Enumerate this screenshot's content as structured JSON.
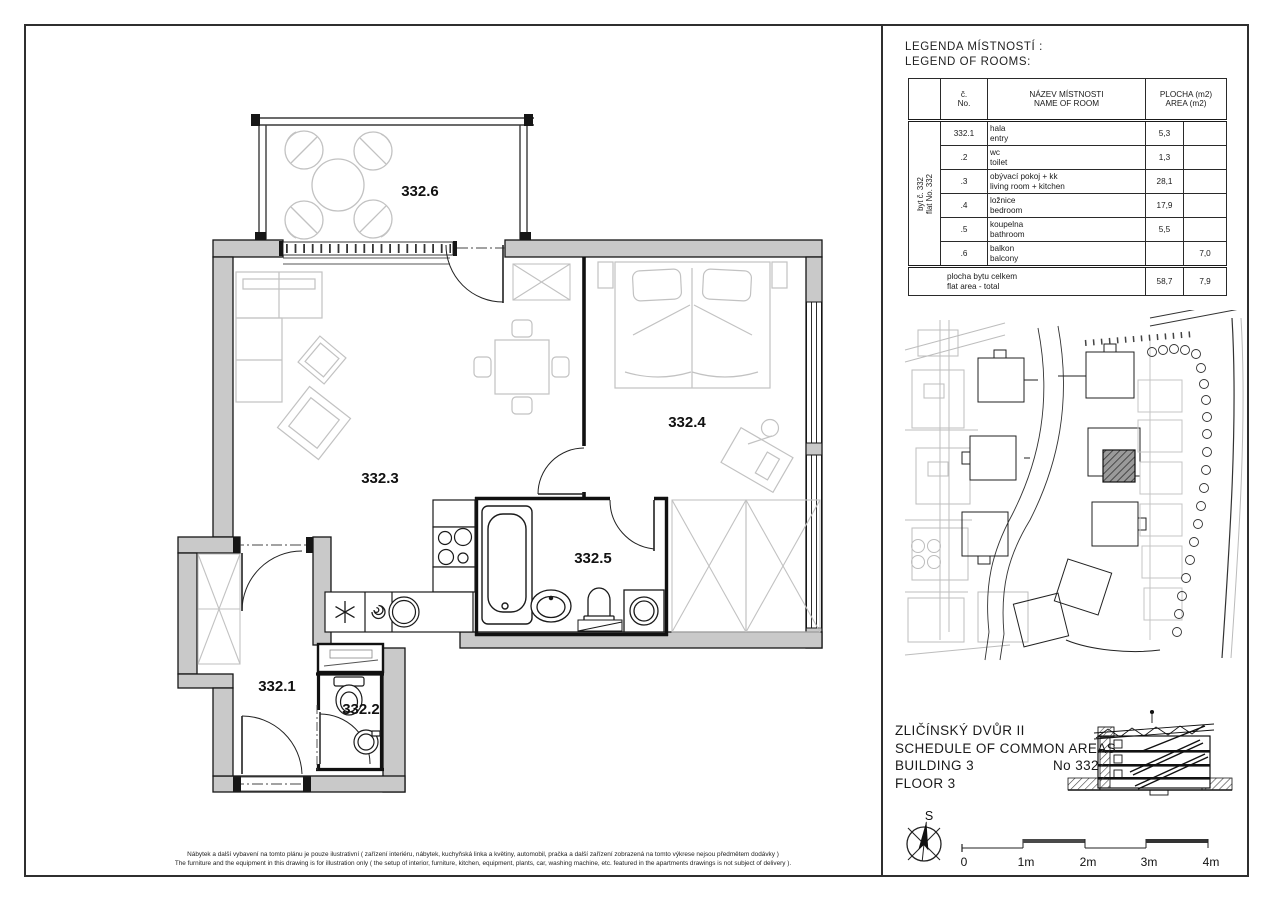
{
  "legend": {
    "title_cs": "LEGENDA MÍSTNOSTÍ :",
    "title_en": "LEGEND OF ROOMS:",
    "table": {
      "flat_cs": "byt č. 332",
      "flat_en": "flat No. 332",
      "header": {
        "no_cs": "č.",
        "no_en": "No.",
        "name_cs": "NÁZEV MÍSTNOSTI",
        "name_en": "NAME OF ROOM",
        "area_cs": "PLOCHA (m2)",
        "area_en": "AREA (m2)"
      },
      "rows": [
        {
          "no": "332.1",
          "name_cs": "hala",
          "name_en": "entry",
          "area": "5,3",
          "area2": ""
        },
        {
          "no": ".2",
          "name_cs": "wc",
          "name_en": "toilet",
          "area": "1,3",
          "area2": ""
        },
        {
          "no": ".3",
          "name_cs": "obývací pokoj + kk",
          "name_en": "living room + kitchen",
          "area": "28,1",
          "area2": ""
        },
        {
          "no": ".4",
          "name_cs": "ložnice",
          "name_en": "bedroom",
          "area": "17,9",
          "area2": ""
        },
        {
          "no": ".5",
          "name_cs": "koupelna",
          "name_en": "bathroom",
          "area": "5,5",
          "area2": ""
        },
        {
          "no": ".6",
          "name_cs": "balkon",
          "name_en": "balcony",
          "area": "",
          "area2": "7,0"
        }
      ],
      "total": {
        "cs": "plocha bytu celkem",
        "en": "flat area - total",
        "area": "58,7",
        "area2": "7,9"
      }
    }
  },
  "plan": {
    "labels": {
      "r1": "332.1",
      "r2": "332.2",
      "r3": "332.3",
      "r4": "332.4",
      "r5": "332.5",
      "r6": "332.6"
    }
  },
  "title_block": {
    "line1": "ZLIČÍNSKÝ DVŮR II",
    "line2": "SCHEDULE OF COMMON AREAS",
    "line3": "BUILDING 3",
    "number": "No 332",
    "line4": "FLOOR 3"
  },
  "compass": {
    "north": "S"
  },
  "scale_bar": {
    "labels": [
      "0",
      "1m",
      "2m",
      "3m",
      "4m"
    ]
  },
  "disclaimer": {
    "cs": "Nábytek a další vybavení na tomto plánu je pouze ilustrativní ( zařízení interiéru, nábytek, kuchyňská linka a květiny, automobil, pračka a další zařízení zobrazená na tomto výkrese nejsou předmětem dodávky )",
    "en": "The furniture and the equipment in this drawing is for illustration only ( the setup of interior, furniture, kitchen, equipment, plants, car, washing machine, etc. featured in the apartments drawings is not subject of delivery )."
  },
  "colors": {
    "wall_fill": "#c9c9c9",
    "line": "#161616",
    "furniture": "#c2c2c2",
    "highlight": "#8f8f8f"
  }
}
